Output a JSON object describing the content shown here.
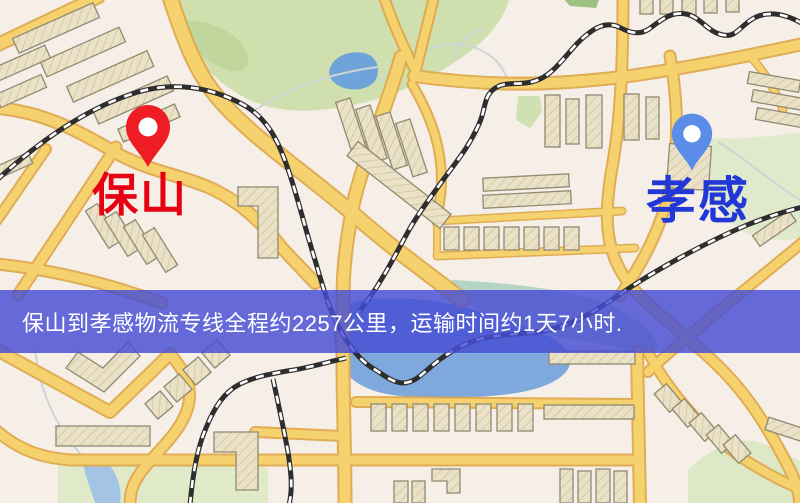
{
  "map": {
    "origin": {
      "label": "保山",
      "icon": "red-map-pin"
    },
    "destination": {
      "label": "孝感",
      "icon": "blue-map-pin"
    }
  },
  "banner": {
    "text": "保山到孝感物流专线全程约2257公里，运输时间约1天7小时."
  },
  "theme": {
    "origin_label_color": "#e60012",
    "origin_pin_color": "#ee1c23",
    "destination_label_color": "#2138d6",
    "destination_pin_color": "#5b8ce8",
    "banner_background": "rgba(70,77,212,0.82)",
    "banner_text_color": "#ffffff"
  }
}
